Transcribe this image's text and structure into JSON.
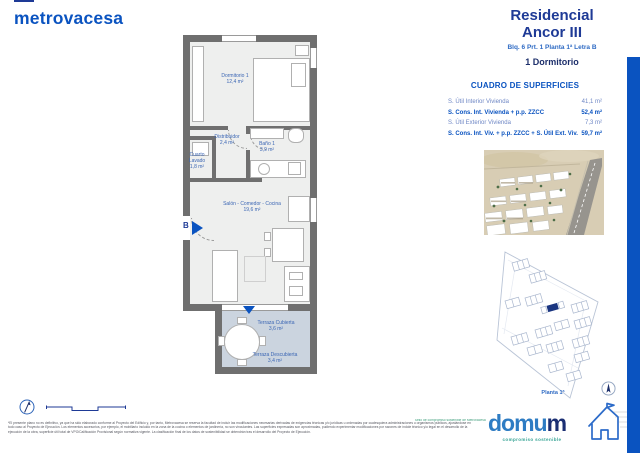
{
  "header": {
    "brand": "metrovacesa",
    "residencial": "Residencial",
    "project": "Ancor III",
    "unit_ref": "Blq. 6 Prt. 1 Planta 1ª Letra B",
    "unit_type": "1 Dormitorio"
  },
  "surfaces": {
    "title": "CUADRO DE SUPERFICIES",
    "rows": [
      {
        "label": "S. Útil Interior Vivienda",
        "value": "41,1 m²",
        "bold": false
      },
      {
        "label": "S. Cons. Int. Vivienda + p.p. ZZCC",
        "value": "52,4 m²",
        "bold": true
      },
      {
        "label": "S. Útil Exterior Vivienda",
        "value": "7,3 m²",
        "bold": false
      },
      {
        "label": "S. Cons. Int. Viv. + p.p. ZZCC + S. Útil Ext. Viv.",
        "value": "59,7 m²",
        "bold": true
      }
    ]
  },
  "floorplan": {
    "entrance_label": "B",
    "rooms": {
      "dormitorio": {
        "name": "Dormitorio 1",
        "area": "12,4 m²"
      },
      "distribuidor": {
        "name": "Distribuidor",
        "area": "2,4 m²"
      },
      "bano": {
        "name": "Baño 1",
        "area": "3,9 m²"
      },
      "lavado": {
        "name": "Cuarto Lavado",
        "area": "1,8 m²"
      },
      "salon": {
        "name": "Salón - Comedor - Cocina",
        "area": "19,6 m²"
      },
      "terraza_cubierta": {
        "name": "Terraza Cubierta",
        "area": "3,6 m²"
      },
      "terraza_descubierta": {
        "name": "Terraza Descubierta",
        "area": "3,4 m²"
      }
    }
  },
  "siteplan": {
    "floor_label": "Planta 1ª"
  },
  "footer": {
    "disclaimer": "*El presente plano no es definitivo, ya que ha sido elaborado conforme al Proyecto del Edificio y, por tanto, Metrovacesa se reserva la facultad de incluir las modificaciones necesarias derivadas de exigencias técnicas y/o jurídicas u ordenadas por cualesquiera administraciones u organismos públicos, ajustándose en todo caso al Proyecto de Ejecución. Los elementos accesorios, por ejemplo, el mobiliario incluido en la zona de la cocina o elementos de jardinería, no son vinculantes. Las superficies expresadas son aproximadas, pudiendo experimentar modificaciones por razones de índole técnico y/o legal en el desarrollo de la ejecución de la obra, superficie útil total de VPO/Calificación Provisional según normativa vigente. La clasificación final de los datos de sostenibilidad se obtendrán tras el desarrollo del Proyecto de Ejecución.",
    "eco_note": "Sello de compromiso sostenible de Metrovacesa",
    "domum_light": "domu",
    "domum_bold": "m",
    "domum_tagline": "compromiso sostenible"
  },
  "colors": {
    "brand_blue": "#0a53c0",
    "deep_blue": "#1e3a96",
    "navy": "#1d2f6b",
    "light_row_blue": "#6f87c5",
    "wall_gray": "#6f6f6f",
    "floor_gray": "#eeefee",
    "terrace_floor": "#cbd4df",
    "domum_teal": "#35a394",
    "siteplan_line": "#b9c4d6",
    "highlight_navy": "#1a3580"
  }
}
